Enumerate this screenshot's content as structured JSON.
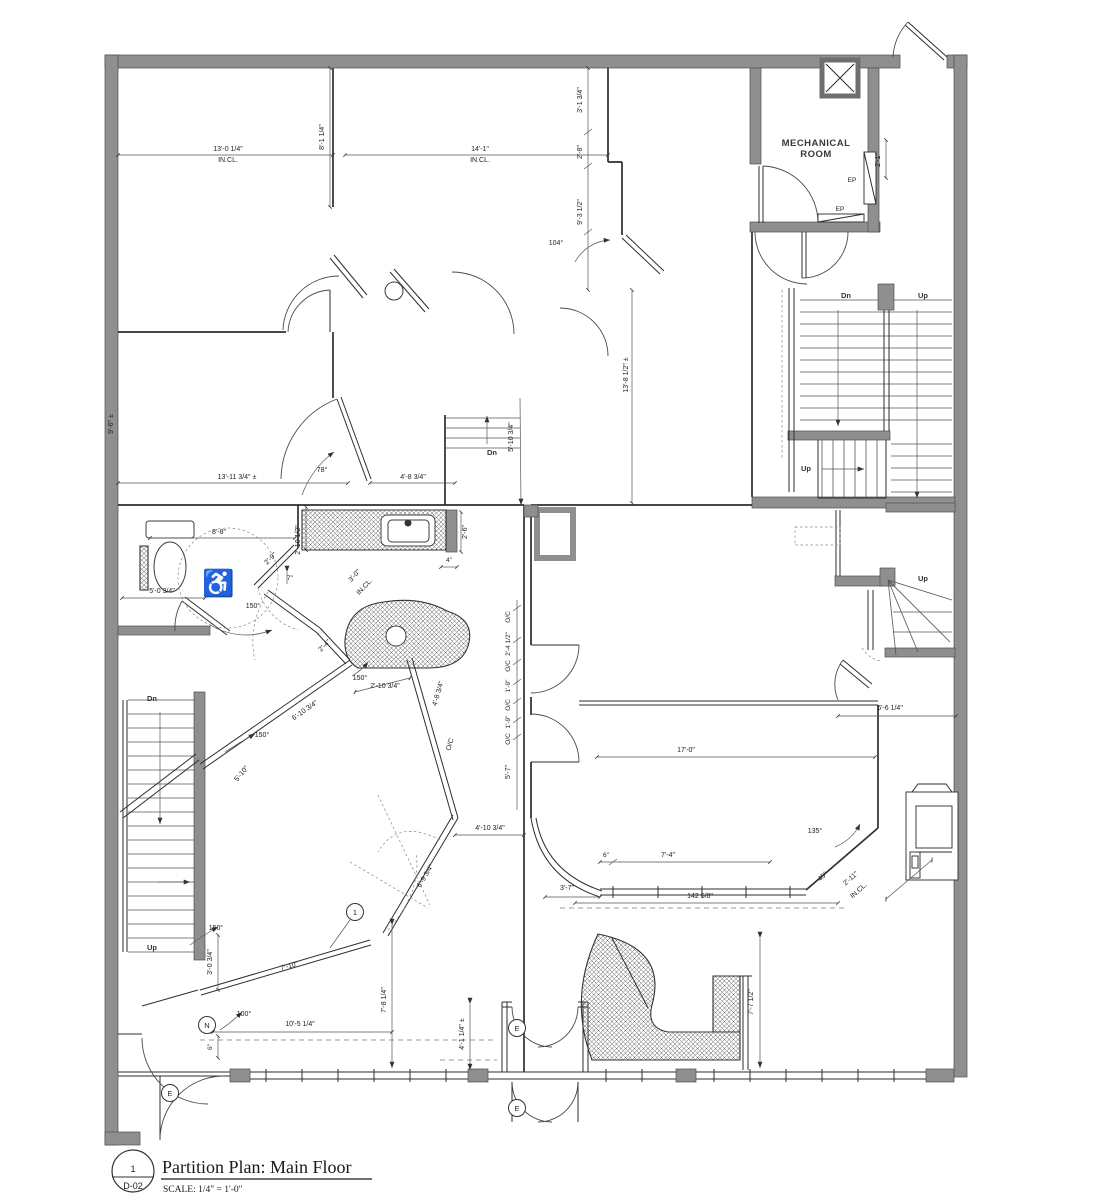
{
  "title_block": {
    "detail_number": "1",
    "sheet_number": "D-02",
    "title": "Partition Plan: Main Floor",
    "scale_note": "SCALE: 1/4\" = 1'-0\""
  },
  "room_labels": {
    "mechanical_line1": "MECHANICAL",
    "mechanical_line2": "ROOM"
  },
  "labels": {
    "dn": "Dn",
    "up": "Up",
    "ep": "EP",
    "in_cl": "IN.CL.",
    "oc": "O/C",
    "entry": "E",
    "north": "N",
    "keynote": "1",
    "accessible_icon": "♿"
  },
  "dims": {
    "d13_0_14": "13'-0 1/4\"",
    "d14_1": "14'-1\"",
    "d8_1_14": "8'-1 1/4\"",
    "d3_1_34": "3'-1 3/4\"",
    "d2_8": "2'-8\"",
    "d9_3_12": "9'-3 1/2\"",
    "d2_1": "2'-1\"",
    "d13_8_12": "13'-8 1/2\" ±",
    "d9_6": "9'-6\" ±",
    "d13_11_34": "13'-11 3/4\" ±",
    "d4_8_34": "4'-8 3/4\"",
    "d5_10_34": "5'-10 3/4\"",
    "d8_8": "8'-8\"",
    "d2_9": "2'-9\"",
    "d2_10_12": "2'-10 1/2\"",
    "d7in": "7\"",
    "d3_0": "3'-0\"",
    "d5_0_34": "5'-0 3/4\"",
    "d2_6": "2'-6\"",
    "d4in": "4\"",
    "d2_4": "2'-4\"",
    "d2_10_34": "2'-10 3/4\"",
    "d6_10_34": "6'-10 3/4\"",
    "d5_10": "5'-10\"",
    "d2_4_12": "2'-4 1/2\"",
    "d1_9": "1'-9\"",
    "d5_7": "5'-7\"",
    "d17_0": "17'-0\"",
    "d6_6_14": "6'-6 1/4\"",
    "d2_11": "2'-11\"",
    "d6in": "6\"",
    "d7_4": "7'-4\"",
    "d3_7": "3'-7\"",
    "d142_58": "142 5/8\"",
    "d4_10_34": "4'-10 3/4\"",
    "d6_9_34": "6'-9 3/4\"",
    "d7_10": "7'-10\"",
    "d10_5_14": "10'-5 1/4\"",
    "d7_8_14": "7'-8 1/4\"",
    "d3_0_34": "3'-0 3/4\"",
    "d4_1_14": "4'-1 1/4\" ±",
    "d7_7_12": "7'-7 1/2\""
  },
  "angles": {
    "a104": "104°",
    "a78": "78°",
    "a150": "150°",
    "a135": "135°",
    "a100": "100°",
    "a45": "45°"
  },
  "colors": {
    "exterior_wall_gray": "#8f8f8f",
    "line_black": "#2e2e2e",
    "paper_white": "#ffffff"
  }
}
